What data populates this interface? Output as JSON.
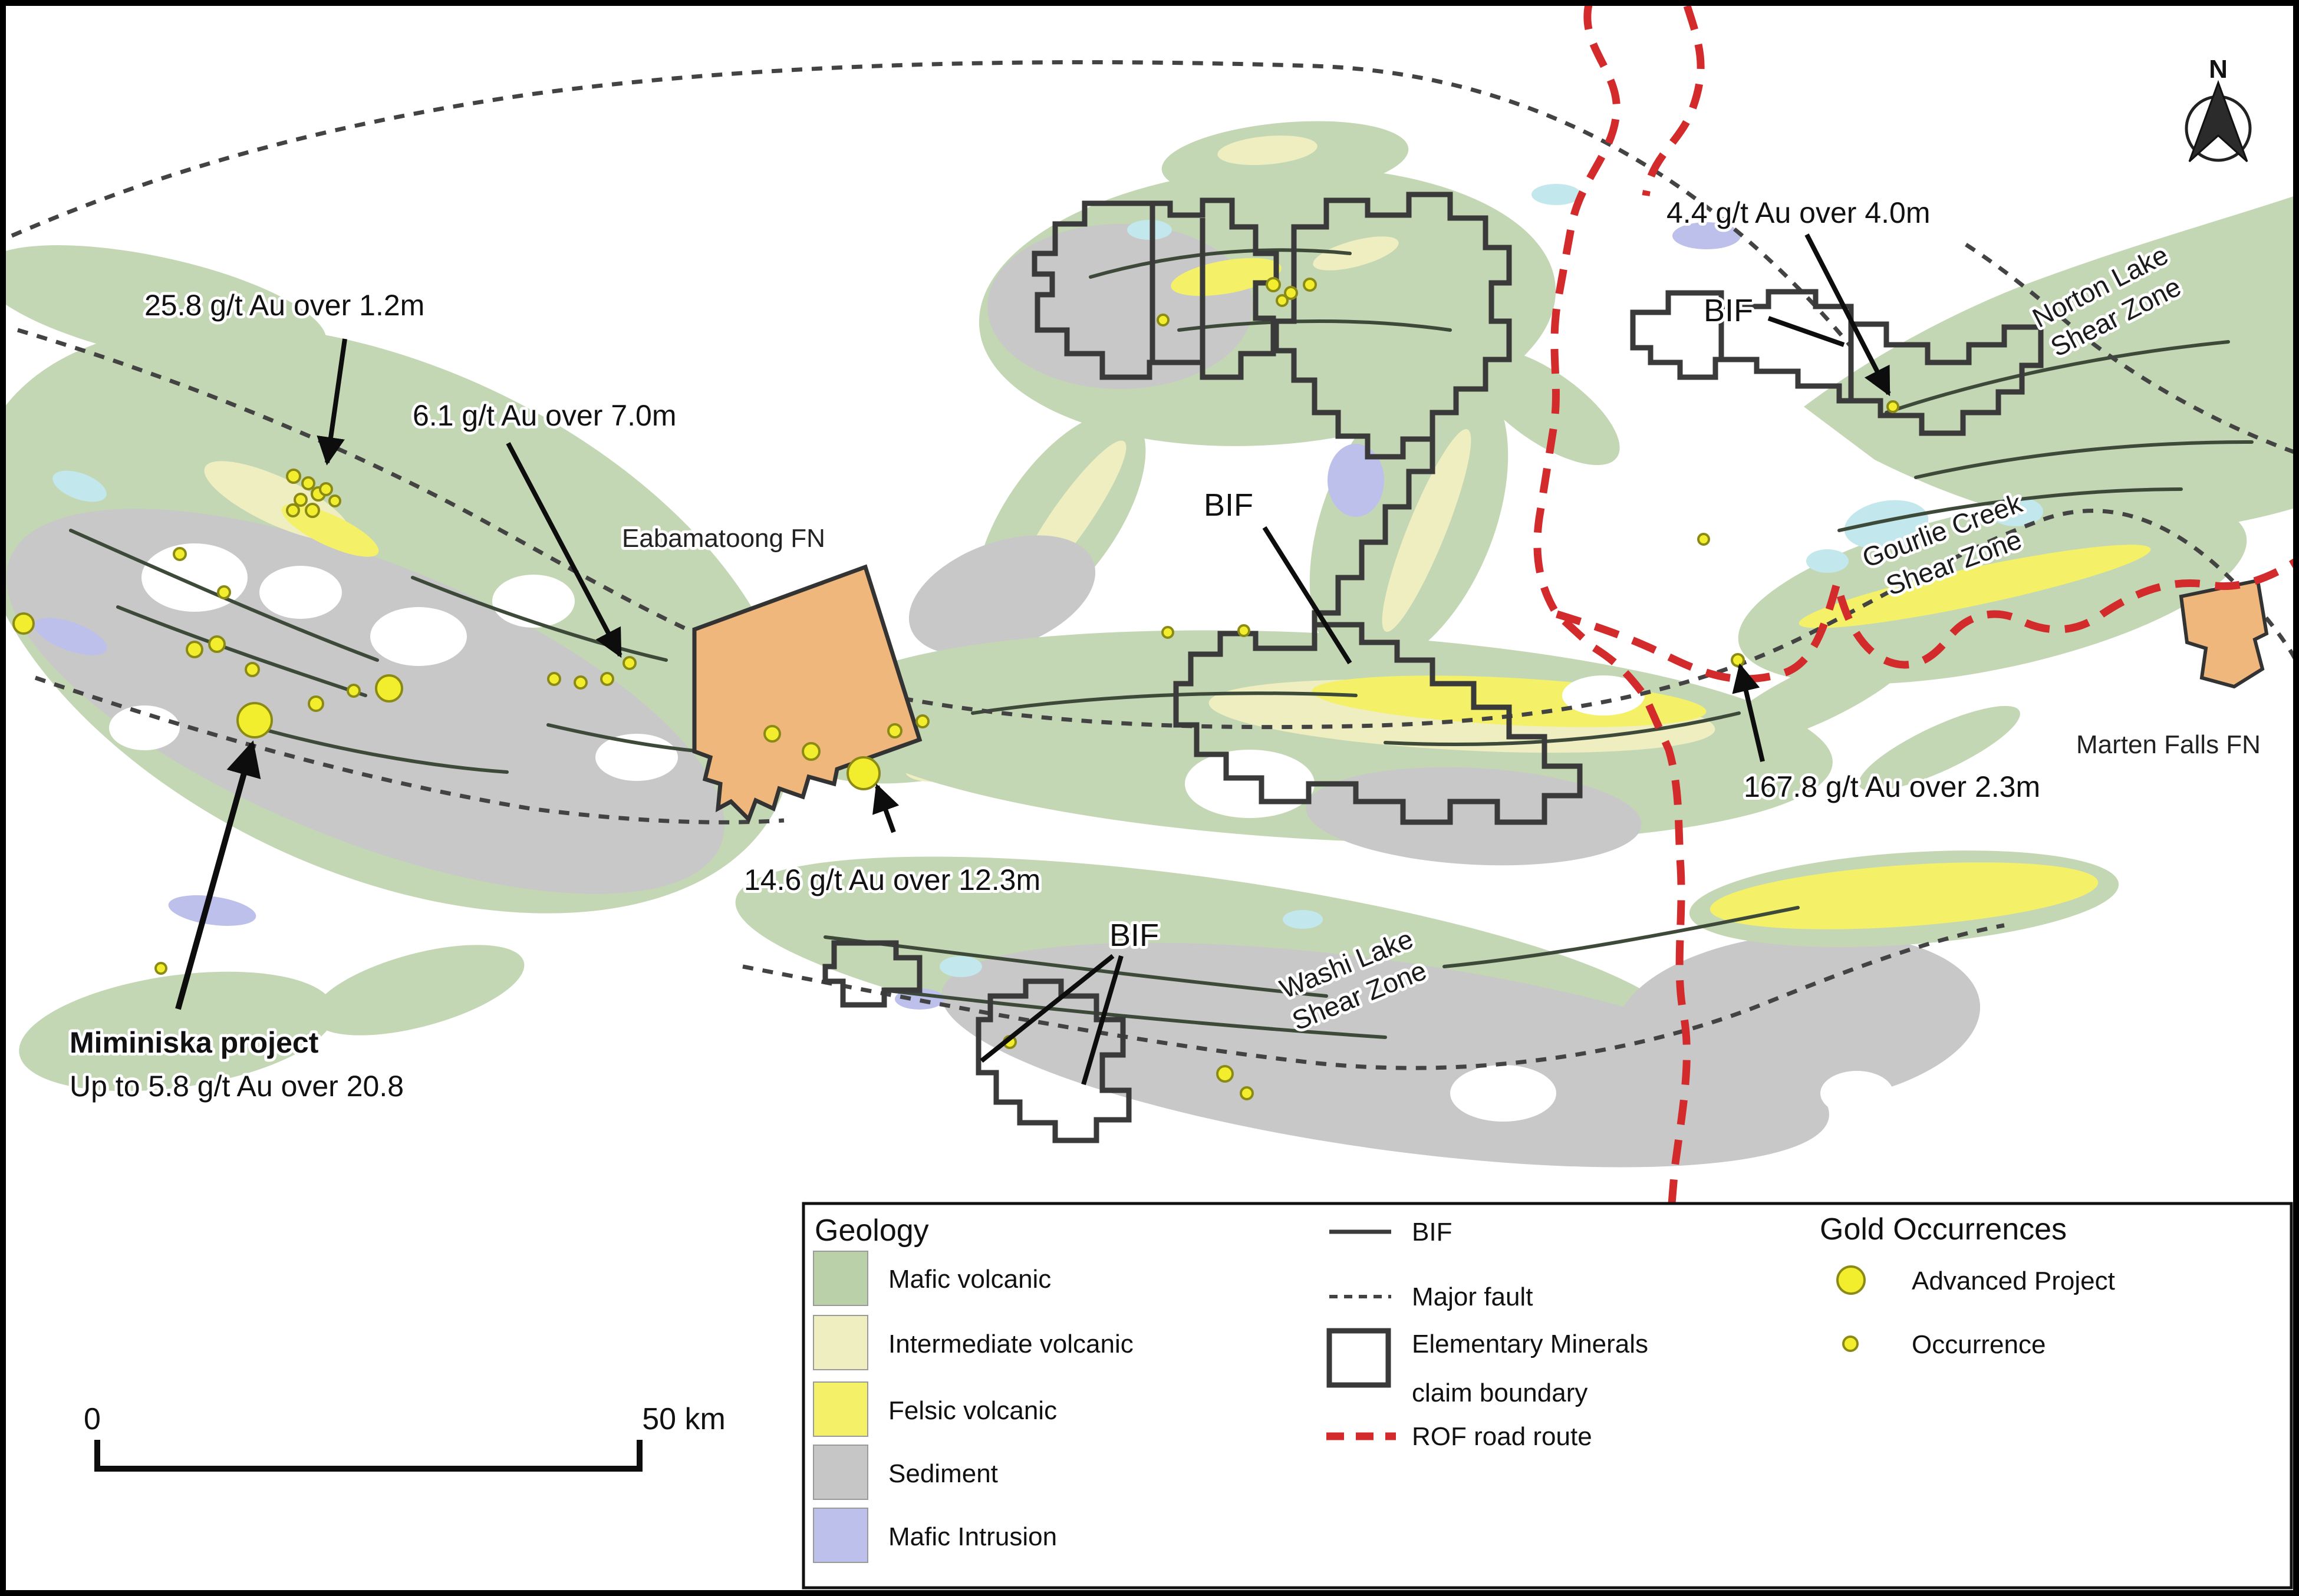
{
  "map": {
    "grades": {
      "g1": "25.8 g/t Au over 1.2m",
      "g2": "6.1 g/t Au over 7.0m",
      "g3": "4.4 g/t Au over 4.0m",
      "g4": "167.8 g/t Au over 2.3m",
      "g5": "14.6 g/t Au over 12.3m"
    },
    "project": {
      "title": "Miminiska project",
      "subtitle": "Up to 5.8 g/t Au over 20.8"
    },
    "bif_labels": {
      "top": "BIF",
      "center": "BIF",
      "lower": "BIF"
    },
    "places": {
      "eabamatoong": "Eabamatoong FN",
      "marten_falls": "Marten Falls FN"
    },
    "shear_zones": {
      "norton_line1": "Norton Lake",
      "norton_line2": "Shear Zone",
      "gourlie_line1": "Gourlie Creek",
      "gourlie_line2": "Shear Zone",
      "washi_line1": "Washi Lake",
      "washi_line2": "Shear Zone"
    },
    "compass": {
      "north_label": "N"
    },
    "scale_bar": {
      "start_label": "0",
      "end_label": "50 km"
    }
  },
  "legend": {
    "geology": {
      "title": "Geology",
      "items": [
        {
          "label": "Mafic volcanic",
          "color": "#b9d0a8"
        },
        {
          "label": "Intermediate volcanic",
          "color": "#eeeec0"
        },
        {
          "label": "Felsic volcanic",
          "color": "#f4f169"
        },
        {
          "label": "Sediment",
          "color": "#c6c6c6"
        },
        {
          "label": "Mafic Intrusion",
          "color": "#bcc0ea"
        }
      ]
    },
    "lines": {
      "bif_label": "BIF",
      "major_fault_label": "Major fault",
      "claim_label_line1": "Elementary Minerals",
      "claim_label_line2": "claim boundary",
      "rof_label": "ROF road route"
    },
    "gold": {
      "title": "Gold Occurrences",
      "advanced_label": "Advanced Project",
      "occurrence_label": "Occurrence"
    }
  },
  "colors": {
    "mafic_volcanic": "#c4d7b4",
    "intermediate_volcanic": "#eeeec0",
    "felsic_volcanic": "#f4f169",
    "sediment": "#c8c8c8",
    "mafic_intrusion": "#bcc0ea",
    "lake": "#c2e7ec",
    "first_nation_reserve": "#efb77c",
    "rof_road": "#d32b2b",
    "gold_dot": "#f2ee2d",
    "claim_boundary": "#3a3a3a"
  }
}
